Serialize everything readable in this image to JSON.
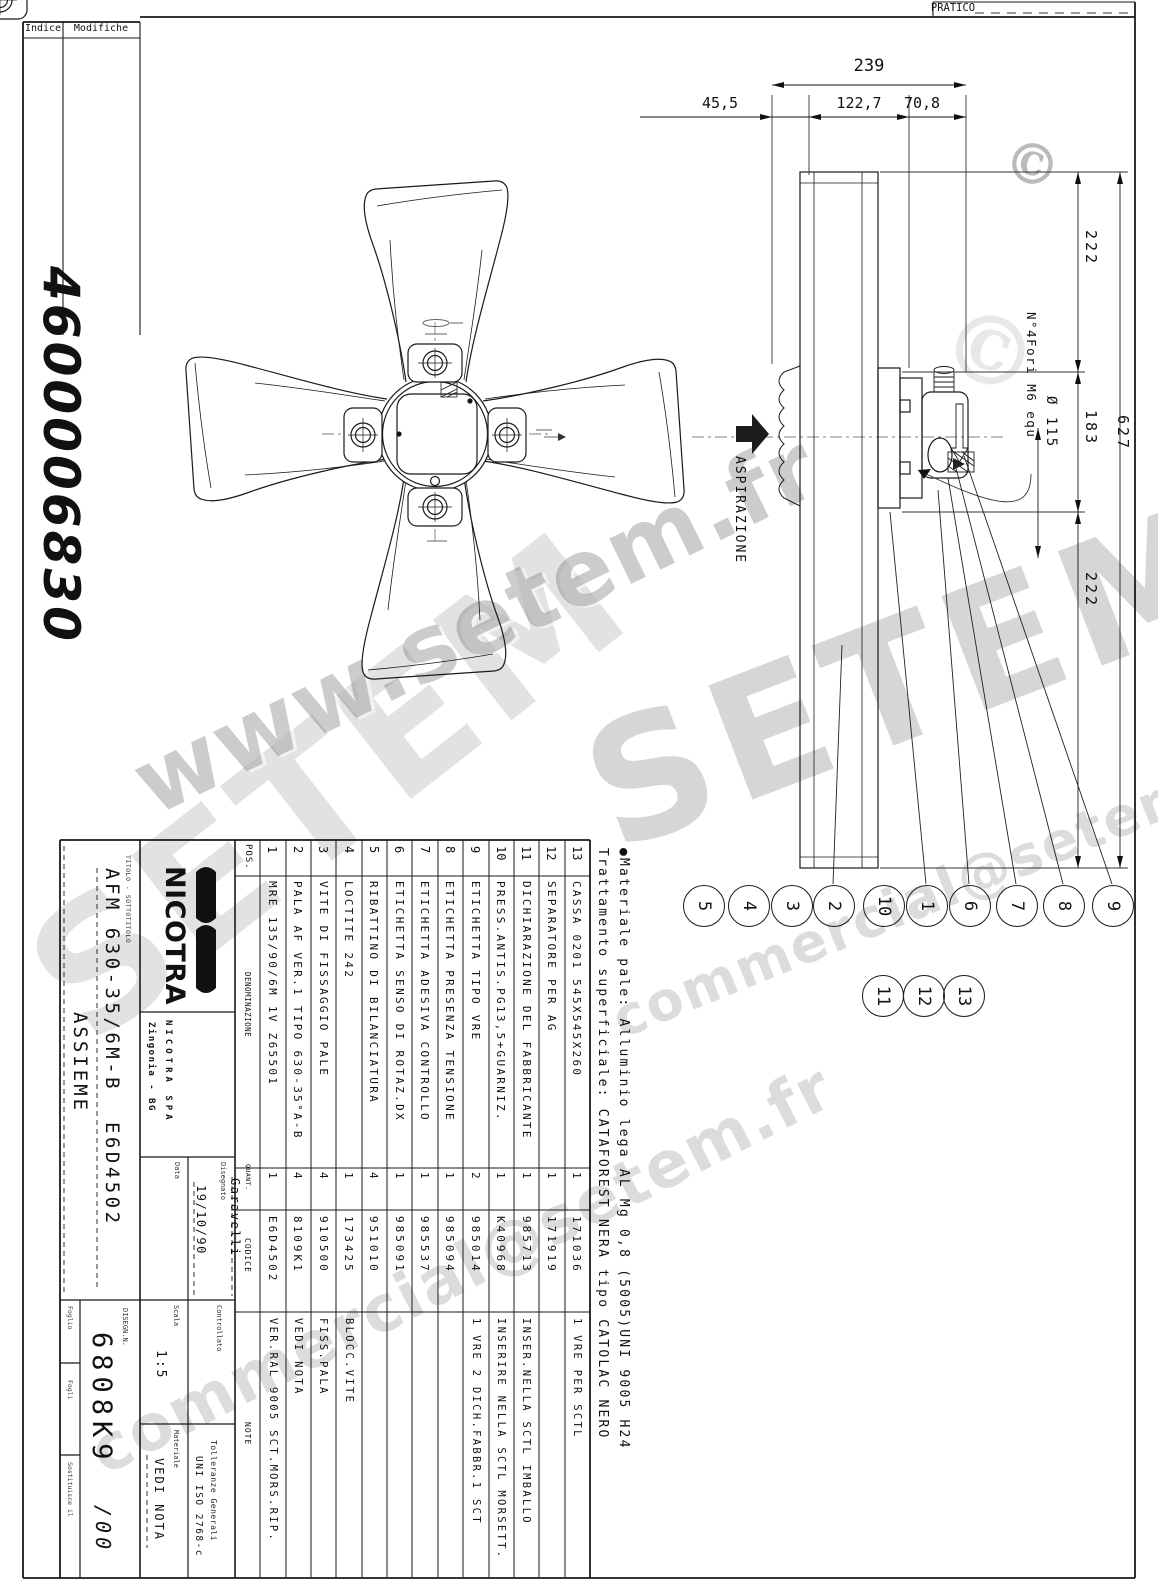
{
  "sheet": {
    "indice_label": "Indice",
    "modifiche_label": "Modifiche",
    "pratico_label": "PRATICO",
    "part_number": "4600006830"
  },
  "watermarks": {
    "brand": "SETEM",
    "url": "www.setem.fr",
    "email": "commercial@setem.fr",
    "copyright": "©"
  },
  "views": {
    "aspirazione_label": "ASPIRAZIONE"
  },
  "dimensions": {
    "top_total": "239",
    "top_a": "45,5",
    "top_b": "122,7",
    "top_c": "70,8",
    "right_top": "222",
    "right_mid": "183",
    "right_bottom": "222",
    "right_total": "627",
    "bolt_circle": "Ø 115",
    "holes_note": "N°4Fori M6 equ"
  },
  "material_note": {
    "line1": "●Materiale pale: Alluminio lega AL Mg 0,8 (5005)UNI 9005 H24",
    "line2": "Trattamento superficiale: CATAFOREST NERA tipo CATOLAC NERO"
  },
  "balloons": [
    {
      "label": "5",
      "x": 703,
      "y": 905
    },
    {
      "label": "4",
      "x": 748,
      "y": 905
    },
    {
      "label": "3",
      "x": 791,
      "y": 905
    },
    {
      "label": "2",
      "x": 833,
      "y": 905
    },
    {
      "label": "10",
      "x": 883,
      "y": 905
    },
    {
      "label": "1",
      "x": 926,
      "y": 905
    },
    {
      "label": "6",
      "x": 969,
      "y": 905
    },
    {
      "label": "7",
      "x": 1016,
      "y": 905
    },
    {
      "label": "8",
      "x": 1063,
      "y": 905
    },
    {
      "label": "9",
      "x": 1112,
      "y": 905
    },
    {
      "label": "11",
      "x": 882,
      "y": 995
    },
    {
      "label": "12",
      "x": 923,
      "y": 995
    },
    {
      "label": "13",
      "x": 963,
      "y": 995
    }
  ],
  "parts_list": {
    "headers": {
      "pos": "POS.",
      "den": "DENOMINAZIONE",
      "qty": "QUANT.",
      "code": "CODICE",
      "note": "NOTE"
    },
    "rows": [
      {
        "pos": "1",
        "den": "MRE 135/90/6M 1V Z65501",
        "qty": "1",
        "code": "E6D4502",
        "note": "VER.RAL 9005 SCT.MORS.RIP."
      },
      {
        "pos": "2",
        "den": "PALA AF VER.1 TIPO 630-35°A-B",
        "qty": "4",
        "code": "8109K1",
        "note": "VEDI NOTA"
      },
      {
        "pos": "3",
        "den": "VITE DI FISSAGGIO PALE",
        "qty": "4",
        "code": "910500",
        "note": "FISS.PALA"
      },
      {
        "pos": "4",
        "den": "LOCTITE 242",
        "qty": "1",
        "code": "173425",
        "note": "BLOCC.VITE"
      },
      {
        "pos": "5",
        "den": "RIBATTINO DI BILANCIATURA",
        "qty": "4",
        "code": "951010",
        "note": ""
      },
      {
        "pos": "6",
        "den": "ETICHETTA SENSO DI ROTAZ.DX",
        "qty": "1",
        "code": "985091",
        "note": ""
      },
      {
        "pos": "7",
        "den": "ETICHETTA ADESIVA CONTROLLO",
        "qty": "1",
        "code": "985537",
        "note": ""
      },
      {
        "pos": "8",
        "den": "ETICHETTA PRESENZA TENSIONE",
        "qty": "1",
        "code": "985094",
        "note": ""
      },
      {
        "pos": "9",
        "den": "ETICHETTA TIPO VRE",
        "qty": "2",
        "code": "985014",
        "note": "1 VRE 2 DICH.FABBR.1 SCT"
      },
      {
        "pos": "10",
        "den": "PRESS.ANTIS.PG13,5+GUARNIZ.",
        "qty": "1",
        "code": "K40968",
        "note": "INSERIRE NELLA SCTL MORSETT."
      },
      {
        "pos": "11",
        "den": "DICHIARAZIONE DEL FABBRICANTE",
        "qty": "1",
        "code": "985713",
        "note": "INSER.NELLA SCTL IMBALLO"
      },
      {
        "pos": "12",
        "den": "SEPARATORE PER AG",
        "qty": "1",
        "code": "171919",
        "note": ""
      },
      {
        "pos": "13",
        "den": "CASSA 0201 545X545X260",
        "qty": "1",
        "code": "171036",
        "note": "1 VRE PER SCTL"
      }
    ]
  },
  "title_block": {
    "logo": "NICOTRA",
    "company": "NICOTRA SPA",
    "location": "Zingonia - BG",
    "titolo_label": "TITOLO - SOTTOTITOLO",
    "title": "AFM 630-35/6M-B  E6D4502",
    "subtitle": "ASSIEME",
    "data_label": "Data",
    "data_value": "19/10/90",
    "disegnato_label": "Disegnato",
    "disegnato_value": "Garavelli",
    "controllato_label": "Controllato",
    "scala_label": "Scala",
    "scala_value": "1:5",
    "materiale_label": "Materiale",
    "materiale_value": "VEDI NOTA",
    "tolleranze_label": "Tolleranze Generali",
    "tolleranze_value": "UNI ISO 2768-c",
    "disegno_label": "DISEGN.N.",
    "disegno_value": "6808K9",
    "revision": "/00",
    "foglio_label": "Foglio",
    "fogli_label": "Fogli",
    "sostituisce_label": "Sostituisce il"
  }
}
